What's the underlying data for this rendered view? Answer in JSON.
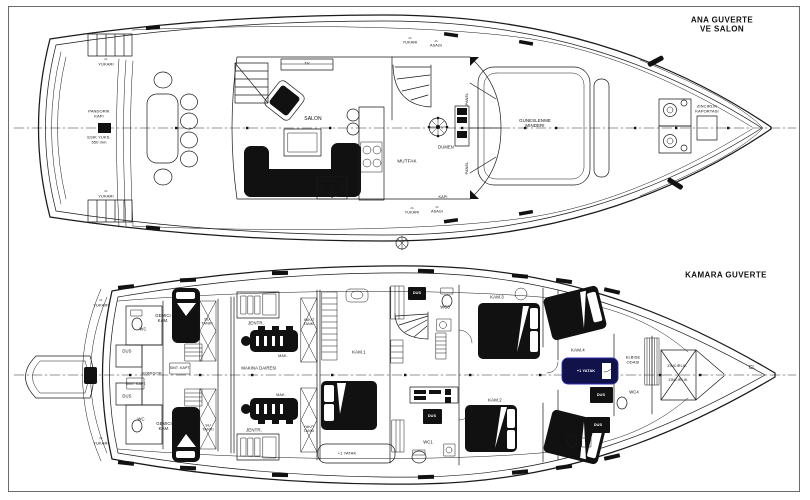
{
  "sheet": {
    "type": "yacht general arrangement drawing",
    "paper_color": "#ffffff",
    "line_color": "#1a1a1a",
    "frame_color": "#6b6b6b",
    "highlight_navy": "#12124a"
  },
  "decks": [
    {
      "id": "main-deck",
      "title": "ANA GUVERTE\nVE SALON",
      "labels": [
        {
          "t": "⇨\nYUKARI",
          "n": "label-yukari",
          "x": 106,
          "y": 62,
          "s": 4
        },
        {
          "t": "⇨\nYUKARI",
          "n": "label-yukari",
          "x": 106,
          "y": 194,
          "s": 4
        },
        {
          "t": "PANDORIK\nKAPI",
          "n": "label-pandorik-kapi",
          "x": 99,
          "y": 114,
          "s": 4
        },
        {
          "t": "ESIK YUKS.\n550 mm",
          "n": "label-esik-yuksekligi",
          "x": 99,
          "y": 140,
          "s": 4
        },
        {
          "t": "TV",
          "n": "label-tv",
          "x": 307,
          "y": 64,
          "s": 4
        },
        {
          "t": "⇨\nYUKARI",
          "n": "label-yukari",
          "x": 410,
          "y": 41,
          "s": 3.8
        },
        {
          "t": "⇦\nASAGI",
          "n": "label-asagi",
          "x": 436,
          "y": 44,
          "s": 3.8
        },
        {
          "t": "SALON",
          "n": "label-salon",
          "x": 313,
          "y": 120,
          "s": 5
        },
        {
          "t": "MUTFAK",
          "n": "label-mutfak",
          "x": 407,
          "y": 161,
          "s": 4.6
        },
        {
          "t": "DUMEN",
          "n": "label-dumen",
          "x": 446,
          "y": 148,
          "s": 4.2
        },
        {
          "t": "PANEL",
          "n": "label-panel",
          "x": 467,
          "y": 99,
          "s": 3.8,
          "r": -90
        },
        {
          "t": "PANEL",
          "n": "label-panel",
          "x": 467,
          "y": 168,
          "s": 3.8,
          "r": -90
        },
        {
          "t": "GUNESLENME\nMINDERI",
          "n": "label-guneslenme-minderi",
          "x": 535,
          "y": 123,
          "s": 4.4
        },
        {
          "t": "ZINCIRLIK\nKAPORTASI",
          "n": "label-zincirlik-kaportasi",
          "x": 707,
          "y": 109,
          "s": 4
        },
        {
          "t": "KAPI",
          "n": "label-kapi",
          "x": 443,
          "y": 197,
          "s": 3.8
        },
        {
          "t": "⇨\nYUKARI",
          "n": "label-yukari",
          "x": 412,
          "y": 211,
          "s": 3.8
        },
        {
          "t": "⇦\nASAGI",
          "n": "label-asagi",
          "x": 437,
          "y": 210,
          "s": 3.8
        }
      ]
    },
    {
      "id": "cabin-deck",
      "title": "KAMARA GUVERTE",
      "labels": [
        {
          "t": "⇨\nYUKARI",
          "n": "label-yukari",
          "x": 101,
          "y": 303,
          "s": 4
        },
        {
          "t": "WC",
          "n": "label-wc",
          "x": 143,
          "y": 330,
          "s": 4.2
        },
        {
          "t": "DUS",
          "n": "label-dus",
          "x": 127,
          "y": 352,
          "s": 4.2
        },
        {
          "t": "GEMICI\nKAM.",
          "n": "label-gemici-kamarasi",
          "x": 163,
          "y": 319,
          "s": 4.2
        },
        {
          "t": "SU\nTANKI",
          "n": "label-su-tanki",
          "x": 207,
          "y": 322,
          "s": 3.8
        },
        {
          "t": "SINT. KAPT.",
          "n": "label-sintine-kapagi",
          "x": 180,
          "y": 368,
          "s": 3.6
        },
        {
          "t": "KORIDOR",
          "n": "label-koridor",
          "x": 152,
          "y": 374,
          "s": 4
        },
        {
          "t": "SINT. KAPT.",
          "n": "label-sintine-kapagi",
          "x": 136,
          "y": 384,
          "s": 3.6
        },
        {
          "t": "MAKINA DAIRESI",
          "n": "label-makina-dairesi",
          "x": 259,
          "y": 369,
          "s": 4.2
        },
        {
          "t": "JENTR.",
          "n": "label-jeneratur",
          "x": 256,
          "y": 323,
          "s": 4.4
        },
        {
          "t": "MAK.",
          "n": "label-makine",
          "x": 283,
          "y": 356,
          "s": 3.8
        },
        {
          "t": "YAKIT\nTANKI",
          "n": "label-yakit-tanki",
          "x": 309,
          "y": 322,
          "s": 3.6
        },
        {
          "t": "KAM.1",
          "n": "label-kamara-1",
          "x": 359,
          "y": 352,
          "s": 4.4
        },
        {
          "t": "DUS",
          "n": "label-dus",
          "x": 417,
          "y": 293,
          "s": 3.8,
          "inv": true
        },
        {
          "t": "WC3",
          "n": "label-wc3",
          "x": 445,
          "y": 308,
          "s": 4.2
        },
        {
          "t": "KAM.3",
          "n": "label-kamara-3",
          "x": 497,
          "y": 297,
          "s": 4.4
        },
        {
          "t": "KAM.4",
          "n": "label-kamara-4",
          "x": 578,
          "y": 350,
          "s": 4.4
        },
        {
          "t": "+1 YATAK",
          "n": "label-plus1-yatak",
          "x": 586,
          "y": 371,
          "s": 3.8,
          "inv": true
        },
        {
          "t": "ELBISE\nODASI",
          "n": "label-elbise-odasi",
          "x": 633,
          "y": 360,
          "s": 4
        },
        {
          "t": "ZINCIRLIK",
          "n": "label-zincirlik",
          "x": 677,
          "y": 366,
          "s": 3.8
        },
        {
          "t": "ZINCIRLIK",
          "n": "label-zincirlik",
          "x": 678,
          "y": 380,
          "s": 3.8
        },
        {
          "t": "CL",
          "n": "label-centerline",
          "x": 752,
          "y": 369,
          "s": 5
        },
        {
          "t": "MAK.",
          "n": "label-makine",
          "x": 281,
          "y": 395,
          "s": 3.8
        },
        {
          "t": "JENTR.",
          "n": "label-jeneratur",
          "x": 254,
          "y": 430,
          "s": 4.4
        },
        {
          "t": "YAKIT\nTANKI",
          "n": "label-yakit-tanki",
          "x": 309,
          "y": 429,
          "s": 3.6
        },
        {
          "t": "GEMICI\nKAM.",
          "n": "label-gemici-kamarasi",
          "x": 164,
          "y": 427,
          "s": 4.2
        },
        {
          "t": "SU\nTANKI",
          "n": "label-su-tanki",
          "x": 208,
          "y": 428,
          "s": 3.8
        },
        {
          "t": "DUS",
          "n": "label-dus",
          "x": 127,
          "y": 397,
          "s": 4.2
        },
        {
          "t": "WC",
          "n": "label-wc",
          "x": 141,
          "y": 420,
          "s": 4.2
        },
        {
          "t": "⇨\nYUKARI",
          "n": "label-yukari",
          "x": 101,
          "y": 441,
          "s": 4
        },
        {
          "t": "+1 YATAK",
          "n": "label-plus1-yatak",
          "x": 347,
          "y": 454,
          "s": 4
        },
        {
          "t": "WC1",
          "n": "label-wc1",
          "x": 428,
          "y": 443,
          "s": 4.2
        },
        {
          "t": "DUS",
          "n": "label-dus",
          "x": 432,
          "y": 416,
          "s": 3.8,
          "inv": true
        },
        {
          "t": "KAM.2",
          "n": "label-kamara-2",
          "x": 495,
          "y": 400,
          "s": 4.4
        },
        {
          "t": "WC2",
          "n": "label-wc2",
          "x": 573,
          "y": 422,
          "s": 4.2
        },
        {
          "t": "DUS",
          "n": "label-dus",
          "x": 601,
          "y": 395,
          "s": 3.8,
          "inv": true
        },
        {
          "t": "DUS",
          "n": "label-dus",
          "x": 598,
          "y": 425,
          "s": 3.8,
          "inv": true
        },
        {
          "t": "WC4",
          "n": "label-wc4",
          "x": 634,
          "y": 393,
          "s": 4.2
        }
      ]
    }
  ]
}
